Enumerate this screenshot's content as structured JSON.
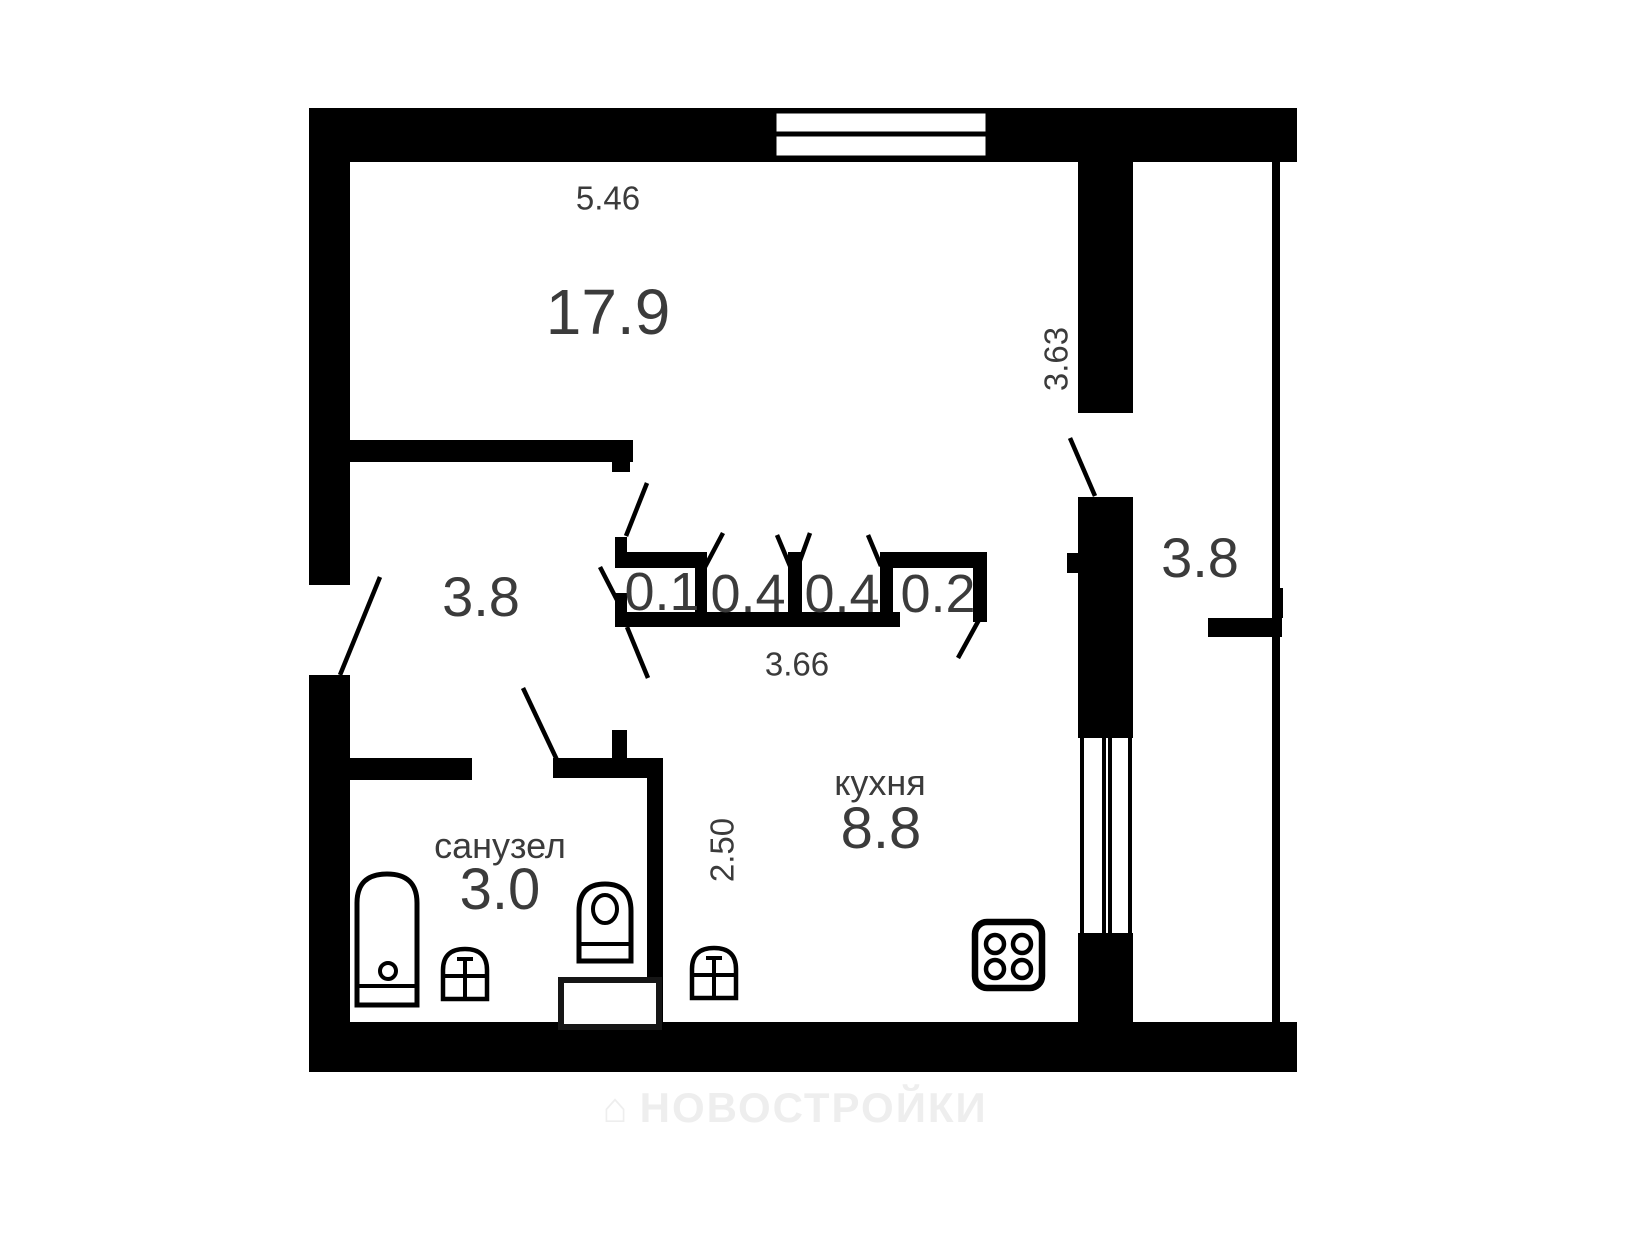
{
  "plan": {
    "rooms": {
      "living": {
        "area": "17.9"
      },
      "hallway": {
        "area": "3.8"
      },
      "bathroom": {
        "name": "санузел",
        "area": "3.0"
      },
      "kitchen": {
        "name": "кухня",
        "area": "8.8"
      },
      "balcony": {
        "area": "3.8"
      },
      "closets": [
        {
          "area": "0.1"
        },
        {
          "area": "0.4"
        },
        {
          "area": "0.4"
        },
        {
          "area": "0.2"
        }
      ]
    },
    "dimensions": {
      "top_wall_width": "5.46",
      "living_balcony_wall": "3.63",
      "closet_row_width": "3.66",
      "kitchen_depth": "2.50"
    }
  },
  "watermark": {
    "text": "НОВОСТРОЙКИ"
  },
  "colors": {
    "wall": "#000000",
    "label_text": "#3b3b3b",
    "watermark": "#eeeeee"
  }
}
